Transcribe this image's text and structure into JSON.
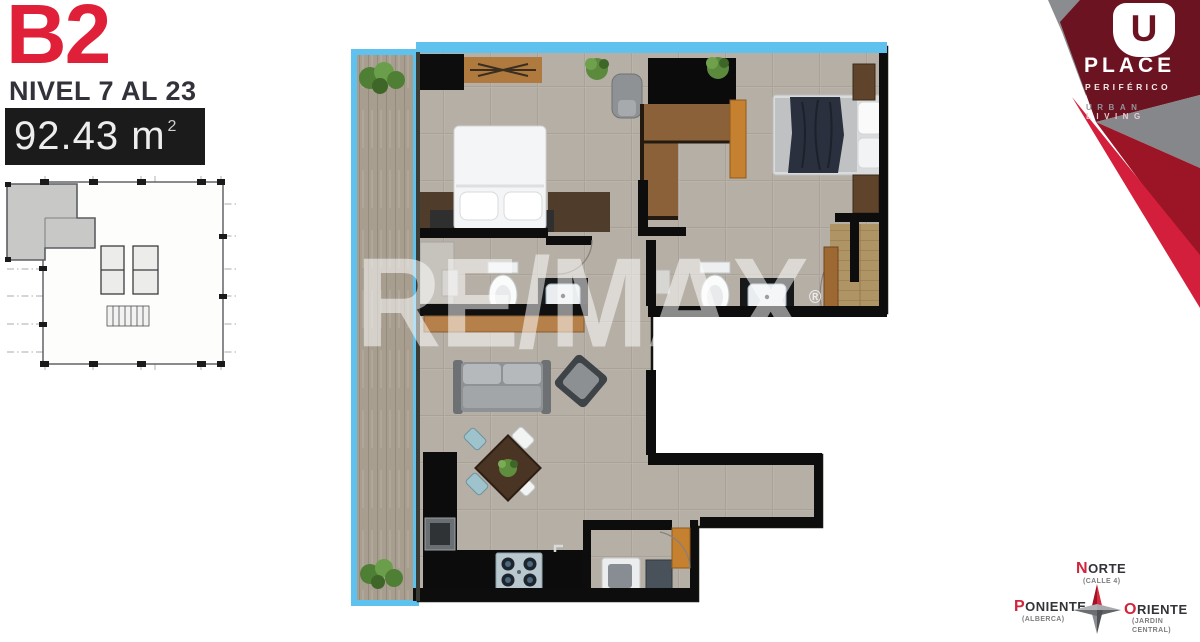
{
  "unit": {
    "code": "B2",
    "level": "NIVEL 7 AL 23",
    "area_value": "92.43 m",
    "area_exponent": "2"
  },
  "watermark": {
    "text": "RE/MAX",
    "reg": "®"
  },
  "brand": {
    "initial": "U",
    "name": "PLACE",
    "subname": "PERIFÉRICO",
    "tagline_urban": "URBAN",
    "tagline_living": "LIVING"
  },
  "compass": {
    "north_initial": "N",
    "north_rest": "ORTE",
    "north_note": "(CALLE 4)",
    "west_initial": "P",
    "west_rest": "ONIENTE",
    "west_note": "(ALBERCA)",
    "east_initial": "O",
    "east_rest": "RIENTE",
    "east_note_line1": "(JARDIN",
    "east_note_line2": "CENTRAL)"
  },
  "colors": {
    "accent_red": "#E02039",
    "maroon": "#6C1322",
    "crimson": "#D31F3B",
    "cyan_terrace": "#5FC2EE",
    "tile": "#B6AFA6",
    "wall": "#0D0D0D",
    "bar_bg": "#1B1B1B",
    "text_dark": "#32323A"
  },
  "icons": {
    "key_plan": "building-key-plan",
    "compass_star": "compass-rose-icon",
    "plants": "plant-icon",
    "u_logo": "u-place-logo"
  }
}
